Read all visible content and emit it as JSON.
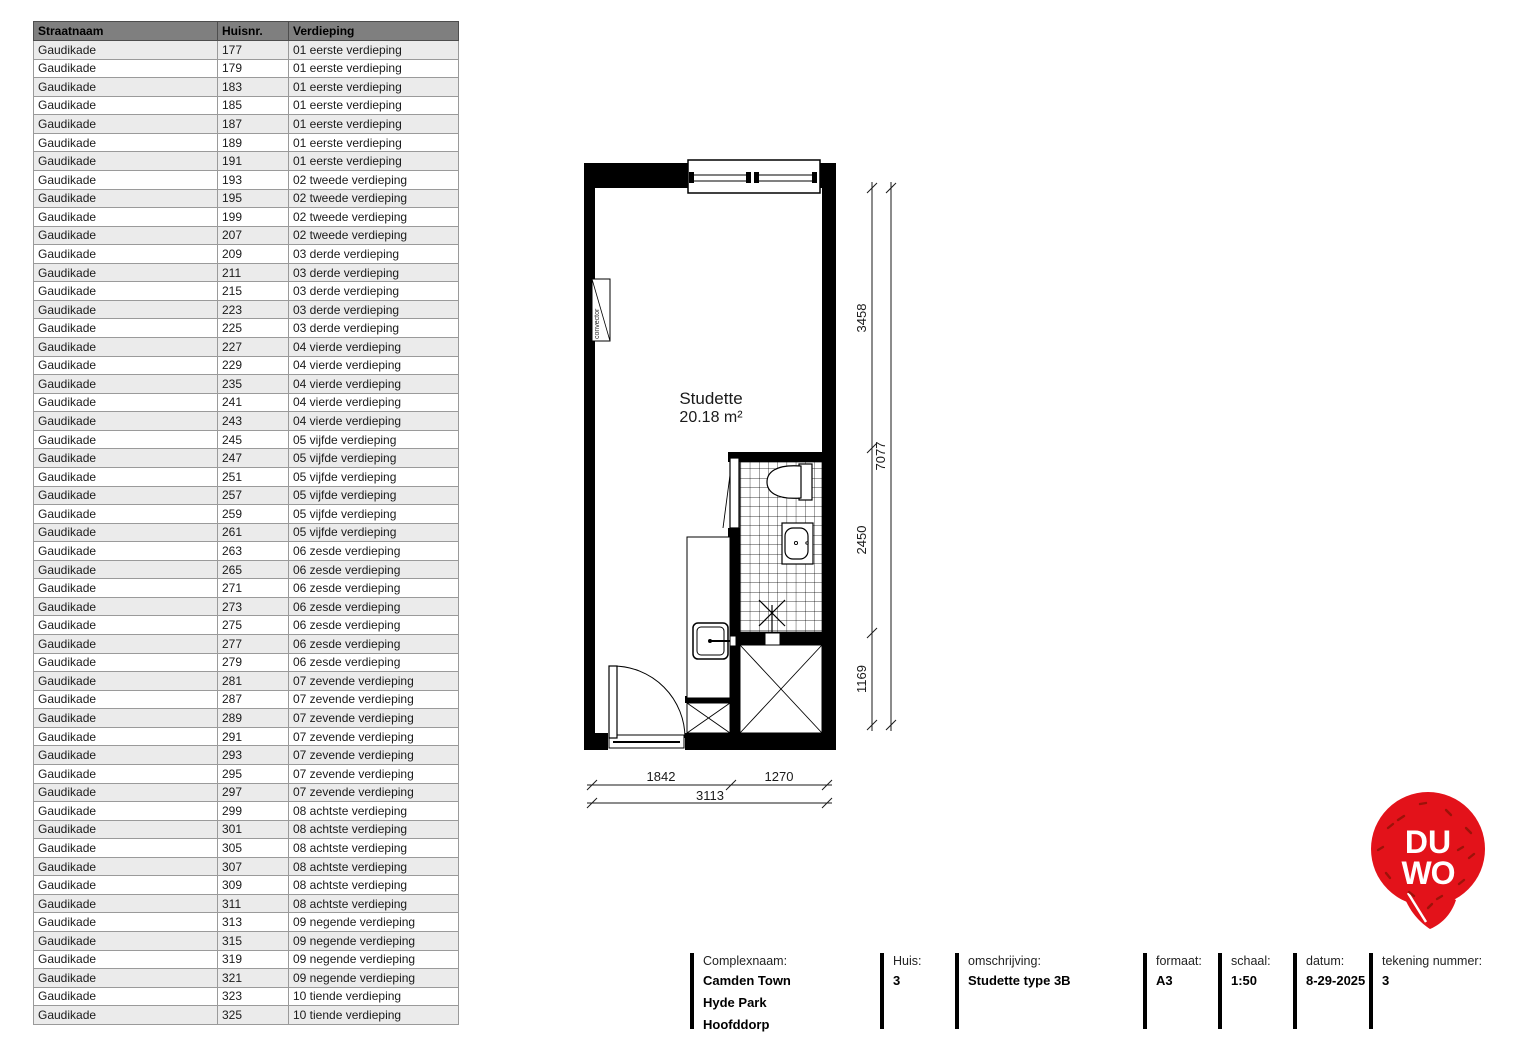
{
  "table": {
    "headers": [
      "Straatnaam",
      "Huisnr.",
      "Verdieping"
    ],
    "rows": [
      [
        "Gaudikade",
        "177",
        "01 eerste verdieping"
      ],
      [
        "Gaudikade",
        "179",
        "01 eerste verdieping"
      ],
      [
        "Gaudikade",
        "183",
        "01 eerste verdieping"
      ],
      [
        "Gaudikade",
        "185",
        "01 eerste verdieping"
      ],
      [
        "Gaudikade",
        "187",
        "01 eerste verdieping"
      ],
      [
        "Gaudikade",
        "189",
        "01 eerste verdieping"
      ],
      [
        "Gaudikade",
        "191",
        "01 eerste verdieping"
      ],
      [
        "Gaudikade",
        "193",
        "02 tweede verdieping"
      ],
      [
        "Gaudikade",
        "195",
        "02 tweede verdieping"
      ],
      [
        "Gaudikade",
        "199",
        "02 tweede verdieping"
      ],
      [
        "Gaudikade",
        "207",
        "02 tweede verdieping"
      ],
      [
        "Gaudikade",
        "209",
        "03 derde verdieping"
      ],
      [
        "Gaudikade",
        "211",
        "03 derde verdieping"
      ],
      [
        "Gaudikade",
        "215",
        "03 derde verdieping"
      ],
      [
        "Gaudikade",
        "223",
        "03 derde verdieping"
      ],
      [
        "Gaudikade",
        "225",
        "03 derde verdieping"
      ],
      [
        "Gaudikade",
        "227",
        "04 vierde verdieping"
      ],
      [
        "Gaudikade",
        "229",
        "04 vierde verdieping"
      ],
      [
        "Gaudikade",
        "235",
        "04 vierde verdieping"
      ],
      [
        "Gaudikade",
        "241",
        "04 vierde verdieping"
      ],
      [
        "Gaudikade",
        "243",
        "04 vierde verdieping"
      ],
      [
        "Gaudikade",
        "245",
        "05 vijfde verdieping"
      ],
      [
        "Gaudikade",
        "247",
        "05 vijfde verdieping"
      ],
      [
        "Gaudikade",
        "251",
        "05 vijfde verdieping"
      ],
      [
        "Gaudikade",
        "257",
        "05 vijfde verdieping"
      ],
      [
        "Gaudikade",
        "259",
        "05 vijfde verdieping"
      ],
      [
        "Gaudikade",
        "261",
        "05 vijfde verdieping"
      ],
      [
        "Gaudikade",
        "263",
        "06 zesde verdieping"
      ],
      [
        "Gaudikade",
        "265",
        "06 zesde verdieping"
      ],
      [
        "Gaudikade",
        "271",
        "06 zesde verdieping"
      ],
      [
        "Gaudikade",
        "273",
        "06 zesde verdieping"
      ],
      [
        "Gaudikade",
        "275",
        "06 zesde verdieping"
      ],
      [
        "Gaudikade",
        "277",
        "06 zesde verdieping"
      ],
      [
        "Gaudikade",
        "279",
        "06 zesde verdieping"
      ],
      [
        "Gaudikade",
        "281",
        "07 zevende verdieping"
      ],
      [
        "Gaudikade",
        "287",
        "07 zevende verdieping"
      ],
      [
        "Gaudikade",
        "289",
        "07 zevende verdieping"
      ],
      [
        "Gaudikade",
        "291",
        "07 zevende verdieping"
      ],
      [
        "Gaudikade",
        "293",
        "07 zevende verdieping"
      ],
      [
        "Gaudikade",
        "295",
        "07 zevende verdieping"
      ],
      [
        "Gaudikade",
        "297",
        "07 zevende verdieping"
      ],
      [
        "Gaudikade",
        "299",
        "08 achtste verdieping"
      ],
      [
        "Gaudikade",
        "301",
        "08 achtste verdieping"
      ],
      [
        "Gaudikade",
        "305",
        "08 achtste verdieping"
      ],
      [
        "Gaudikade",
        "307",
        "08 achtste verdieping"
      ],
      [
        "Gaudikade",
        "309",
        "08 achtste verdieping"
      ],
      [
        "Gaudikade",
        "311",
        "08 achtste verdieping"
      ],
      [
        "Gaudikade",
        "313",
        "09 negende verdieping"
      ],
      [
        "Gaudikade",
        "315",
        "09 negende verdieping"
      ],
      [
        "Gaudikade",
        "319",
        "09 negende verdieping"
      ],
      [
        "Gaudikade",
        "321",
        "09 negende verdieping"
      ],
      [
        "Gaudikade",
        "323",
        "10 tiende verdieping"
      ],
      [
        "Gaudikade",
        "325",
        "10 tiende verdieping"
      ]
    ]
  },
  "floorplan": {
    "room_name": "Studette",
    "room_area": "20.18 m²",
    "convector_label": "convector",
    "dim_right_segments": [
      "3458",
      "2450",
      "1169"
    ],
    "dim_right_total": "7077",
    "dim_bottom_segments": [
      "1842",
      "1270"
    ],
    "dim_bottom_total": "3113"
  },
  "logo": {
    "text_top": "DU",
    "text_bottom": "WO",
    "color": "#e3121a",
    "sprinkle_color": "#9c1209"
  },
  "titleblock": {
    "complexnaam_label": "Complexnaam:",
    "complexnaam_lines": [
      "Camden Town",
      "Hyde Park",
      "Hoofddorp"
    ],
    "huis_label": "Huis:",
    "huis_value": "3",
    "omschrijving_label": "omschrijving:",
    "omschrijving_value": "Studette type 3B",
    "formaat_label": "formaat:",
    "formaat_value": "A3",
    "schaal_label": "schaal:",
    "datum_label": "datum:",
    "schaal_value": "1:50",
    "datum_value": "8-29-2025",
    "tekening_label": "tekening nummer:",
    "tekening_value": "3"
  },
  "colors": {
    "table_header_bg": "#7f7f7f",
    "table_alt_row_bg": "#ebebeb",
    "wall": "#000000"
  }
}
